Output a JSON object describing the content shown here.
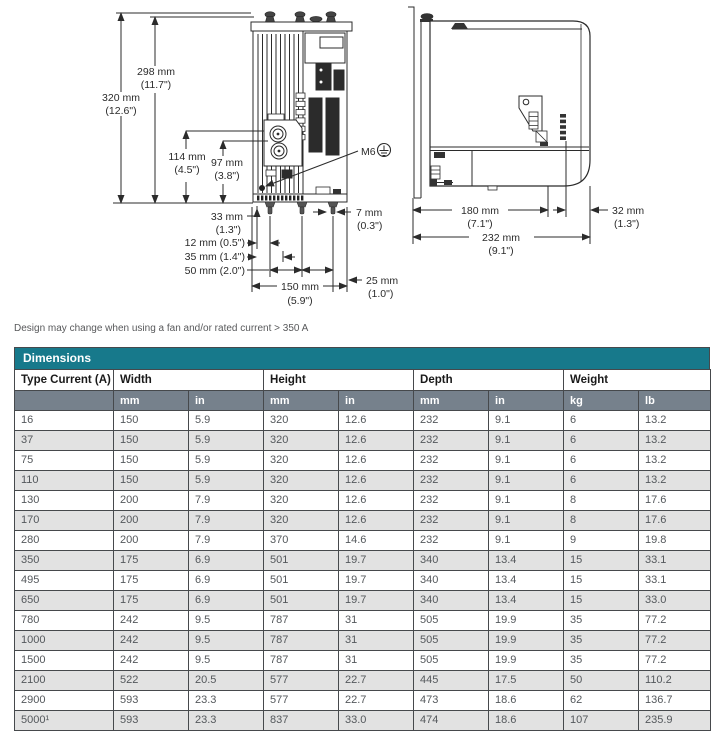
{
  "note": "Design may change when using a fan and/or rated current > 350 A",
  "diagram": {
    "front": {
      "d320": "320 mm",
      "d320_in": "(12.6\")",
      "d298": "298 mm",
      "d298_in": "(11.7\")",
      "d114": "114 mm",
      "d114_in": "(4.5\")",
      "d97": "97 mm",
      "d97_in": "(3.8\")",
      "m6": "M6",
      "d7": "7 mm",
      "d7_in": "(0.3\")",
      "d33": "33 mm",
      "d33_in": "(1.3\")",
      "d12": "12 mm (0.5\")",
      "d35": "35 mm (1.4\")",
      "d50": "50 mm (2.0\")",
      "d150": "150 mm",
      "d150_in": "(5.9\")",
      "d25": "25 mm",
      "d25_in": "(1.0\")"
    },
    "side": {
      "d180": "180 mm",
      "d180_in": "(7.1\")",
      "d32": "32 mm",
      "d32_in": "(1.3\")",
      "d232": "232 mm",
      "d232_in": "(9.1\")"
    }
  },
  "table": {
    "title": "Dimensions",
    "col_groups": [
      "Type Current (A)",
      "Width",
      "Height",
      "Depth",
      "Weight"
    ],
    "units": [
      "mm",
      "in",
      "mm",
      "in",
      "mm",
      "in",
      "kg",
      "lb"
    ],
    "rows": [
      [
        "16",
        "150",
        "5.9",
        "320",
        "12.6",
        "232",
        "9.1",
        "6",
        "13.2"
      ],
      [
        "37",
        "150",
        "5.9",
        "320",
        "12.6",
        "232",
        "9.1",
        "6",
        "13.2"
      ],
      [
        "75",
        "150",
        "5.9",
        "320",
        "12.6",
        "232",
        "9.1",
        "6",
        "13.2"
      ],
      [
        "110",
        "150",
        "5.9",
        "320",
        "12.6",
        "232",
        "9.1",
        "6",
        "13.2"
      ],
      [
        "130",
        "200",
        "7.9",
        "320",
        "12.6",
        "232",
        "9.1",
        "8",
        "17.6"
      ],
      [
        "170",
        "200",
        "7.9",
        "320",
        "12.6",
        "232",
        "9.1",
        "8",
        "17.6"
      ],
      [
        "280",
        "200",
        "7.9",
        "370",
        "14.6",
        "232",
        "9.1",
        "9",
        "19.8"
      ],
      [
        "350",
        "175",
        "6.9",
        "501",
        "19.7",
        "340",
        "13.4",
        "15",
        "33.1"
      ],
      [
        "495",
        "175",
        "6.9",
        "501",
        "19.7",
        "340",
        "13.4",
        "15",
        "33.1"
      ],
      [
        "650",
        "175",
        "6.9",
        "501",
        "19.7",
        "340",
        "13.4",
        "15",
        "33.0"
      ],
      [
        "780",
        "242",
        "9.5",
        "787",
        "31",
        "505",
        "19.9",
        "35",
        "77.2"
      ],
      [
        "1000",
        "242",
        "9.5",
        "787",
        "31",
        "505",
        "19.9",
        "35",
        "77.2"
      ],
      [
        "1500",
        "242",
        "9.5",
        "787",
        "31",
        "505",
        "19.9",
        "35",
        "77.2"
      ],
      [
        "2100",
        "522",
        "20.5",
        "577",
        "22.7",
        "445",
        "17.5",
        "50",
        "110.2"
      ],
      [
        "2900",
        "593",
        "23.3",
        "577",
        "22.7",
        "473",
        "18.6",
        "62",
        "136.7"
      ],
      [
        "5000¹",
        "593",
        "23.3",
        "837",
        "33.0",
        "474",
        "18.6",
        "107",
        "235.9"
      ]
    ]
  },
  "colors": {
    "teal": "#17798b",
    "slate": "#76818c",
    "row_alt": "#e2e2e2"
  }
}
